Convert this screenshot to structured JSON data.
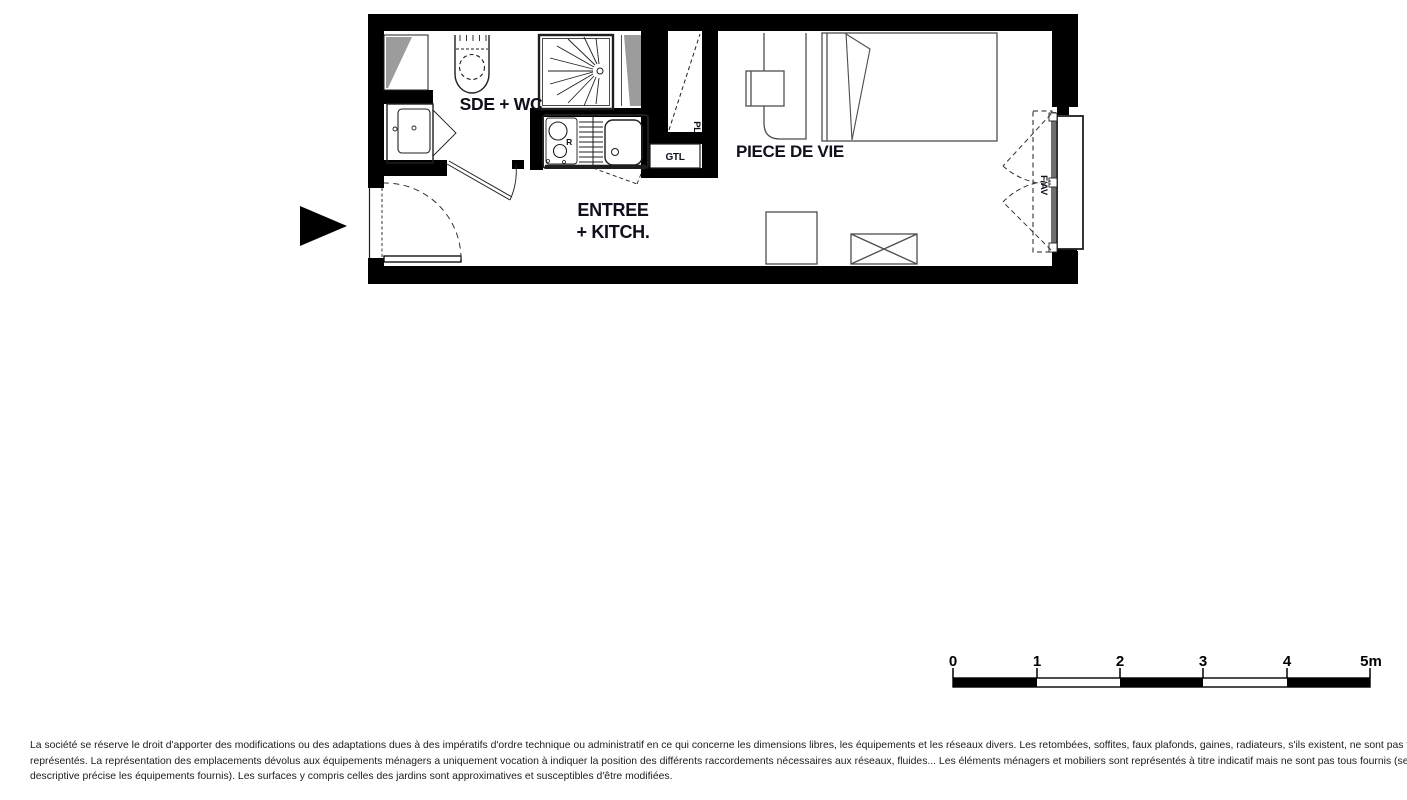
{
  "plan": {
    "room_labels": {
      "bathroom": "SDE + WC",
      "entry_kitchen_line1": "ENTREE",
      "entry_kitchen_line2": "+ KITCH.",
      "living_room": "PIECE DE VIE"
    },
    "annotations": {
      "technical_duct": "GTL",
      "closet": "PL",
      "window": "F/AV",
      "fridge": "R"
    }
  },
  "scale_bar": {
    "tick_labels": [
      "0",
      "1",
      "2",
      "3",
      "4",
      "5m"
    ],
    "unit": "m"
  },
  "disclaimer": {
    "line1": "La société se réserve le droit d'apporter des modifications ou des adaptations dues à des impératifs d'ordre technique ou administratif en ce qui concerne les dimensions libres, les équipements et les réseaux divers. Les retombées, soffites, faux plafonds, gaines, radiateurs, s'ils existent, ne sont pas tous",
    "line2": "représentés. La représentation des emplacements dévolus aux équipements ménagers a uniquement vocation à indiquer la position des différents raccordements nécessaires aux réseaux, fluides... Les éléments ménagers et mobiliers sont représentés à titre indicatif mais ne sont pas tous fournis (seule la notice",
    "line3": "descriptive précise les équipements fournis). Les surfaces y compris celles des jardins sont approximatives et susceptibles d'être modifiées."
  },
  "colors": {
    "wall": "#000000",
    "duct_shade": "#9c9c9c",
    "label_text": "#10101c",
    "fixture_line": "#1f1f1f",
    "furniture_line": "#4d4d4d",
    "window_frame": "#6e6e6e"
  }
}
